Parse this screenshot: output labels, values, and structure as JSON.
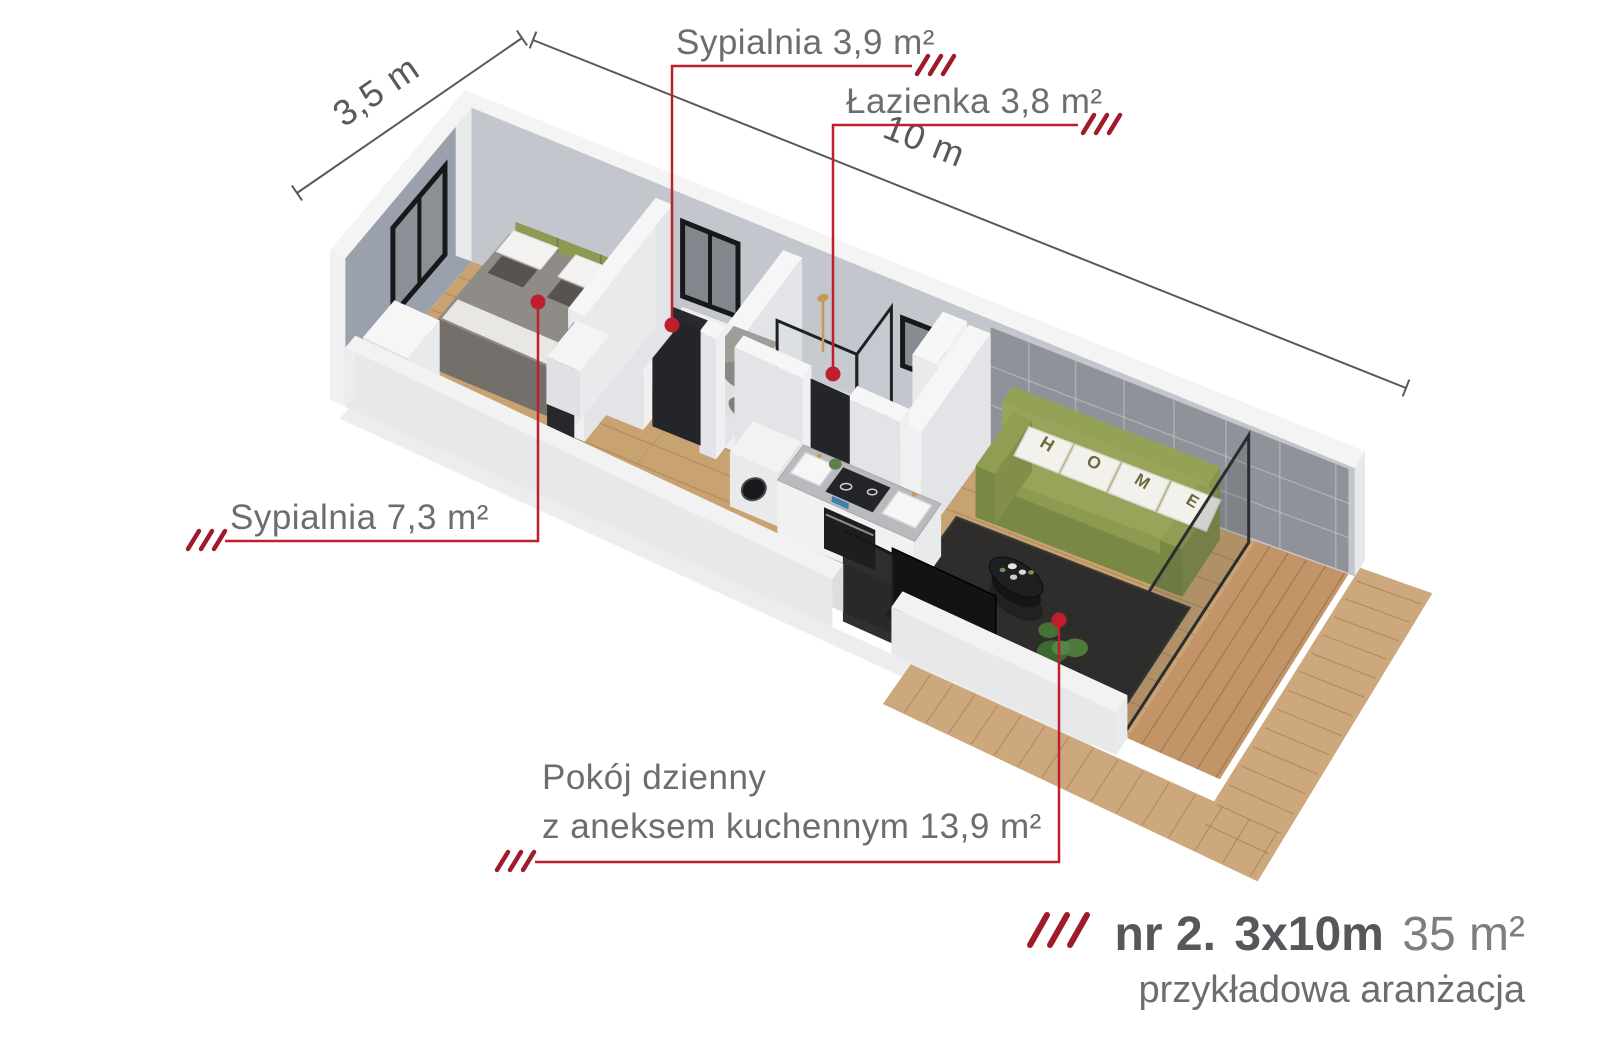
{
  "title": "Rzut mieszkania nr 2",
  "colors": {
    "accent_red": "#bf1e2d",
    "hash_red": "#9e1b29",
    "label_gray": "#6c6d70",
    "dim_gray": "#58595c",
    "footer_dark": "#56575a",
    "footer_light": "#7d7e81"
  },
  "dimensions": {
    "width_label": "3,5 m",
    "length_label": "10 m"
  },
  "rooms": {
    "bedroom_small": "Sypialnia 3,9 m²",
    "bathroom": "Łazienka 3,8 m²",
    "bedroom_main": "Sypialnia 7,3 m²",
    "living_line1": "Pokój dzienny",
    "living_line2": "z aneksem kuchennym 13,9 m²"
  },
  "footer": {
    "unit": "nr 2.",
    "size": "3x10m",
    "area": "35 m²",
    "subtitle": "przykładowa aranżacja"
  },
  "decor": {
    "pillow_letters": [
      "H",
      "O",
      "M",
      "E"
    ]
  }
}
